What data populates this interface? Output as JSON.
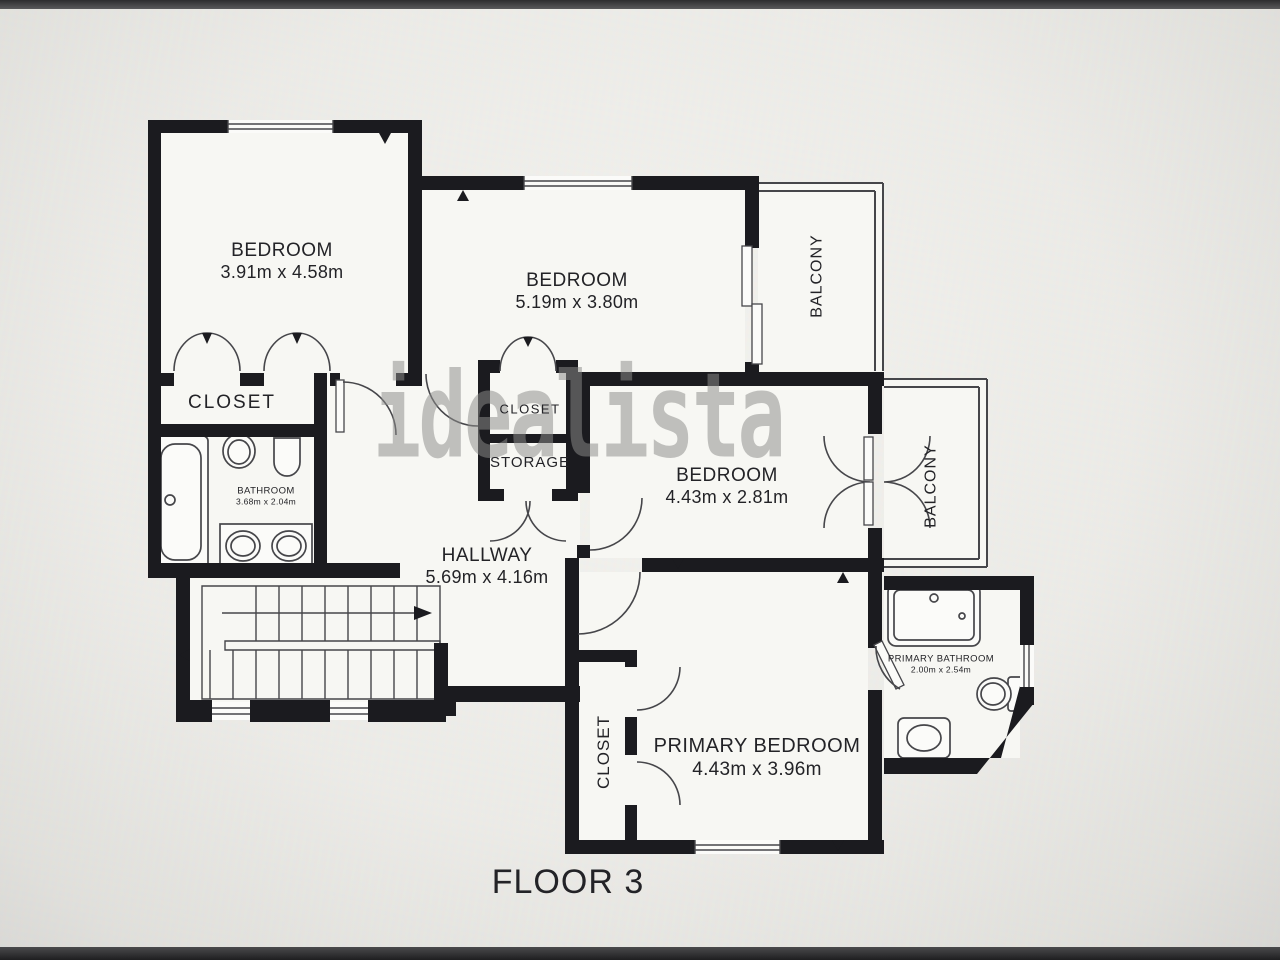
{
  "floor_label": "FLOOR 3",
  "watermark": "idealista",
  "rooms": {
    "bedroom1": {
      "name": "BEDROOM",
      "dims": "3.91m x 4.58m"
    },
    "bedroom2": {
      "name": "BEDROOM",
      "dims": "5.19m x 3.80m"
    },
    "bedroom3": {
      "name": "BEDROOM",
      "dims": "4.43m x 2.81m"
    },
    "primary_bedroom": {
      "name": "PRIMARY BEDROOM",
      "dims": "4.43m x 3.96m"
    },
    "hallway": {
      "name": "HALLWAY",
      "dims": "5.69m x 4.16m"
    },
    "bathroom": {
      "name": "BATHROOM",
      "dims": "3.68m x 2.04m"
    },
    "primary_bathroom": {
      "name": "PRIMARY BATHROOM",
      "dims": "2.00m x 2.54m"
    },
    "closet_left": {
      "name": "CLOSET"
    },
    "closet_mid": {
      "name": "CLOSET"
    },
    "storage": {
      "name": "STORAGE"
    },
    "closet_primary": {
      "name": "CLOSET"
    },
    "balcony_top": {
      "name": "BALCONY"
    },
    "balcony_right": {
      "name": "BALCONY"
    }
  },
  "colors": {
    "wall": "#1b1b1f",
    "line": "#46464a",
    "paper": "#f7f7f3",
    "background": "#e9e8e4",
    "watermark": "#8d8d8b",
    "text": "#232327"
  }
}
